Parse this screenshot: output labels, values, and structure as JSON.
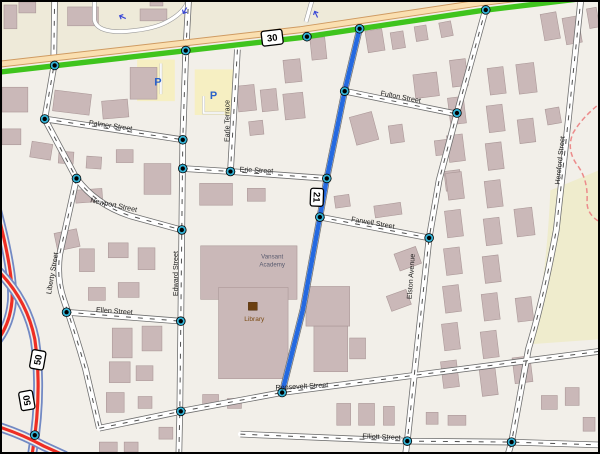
{
  "map": {
    "colors": {
      "background": "#f2efe9",
      "north_zone": "#eeead9",
      "east_zone": "#efeccd",
      "building": "#cab8b8",
      "route30_green": "#3fc41d",
      "route30_road": "#fadfb0",
      "highlight_route_blue": "#2469e0",
      "motorway_red": "#ee2e24",
      "motorway_blue": "#7289c4",
      "node_ring": "#34b3d6",
      "parking_fill": "#f6efc2",
      "parking_letter": "#2a62c9",
      "footpath_red": "#ec8b8b"
    },
    "shields": [
      {
        "label": "30",
        "x": 272,
        "y": 36,
        "rot": -7,
        "w": 21,
        "h": 15
      },
      {
        "label": "21",
        "x": 317,
        "y": 197,
        "rot": 92,
        "w": 18,
        "h": 13
      },
      {
        "label": "50",
        "x": 36,
        "y": 361,
        "rot": -80,
        "w": 19,
        "h": 14
      },
      {
        "label": "50",
        "x": 25,
        "y": 402,
        "rot": -100,
        "w": 19,
        "h": 14
      }
    ],
    "street_labels": [
      {
        "label": "Palmer Street",
        "x": 109,
        "y": 127,
        "rot": 8
      },
      {
        "label": "Erie Street",
        "x": 256,
        "y": 172,
        "rot": 3
      },
      {
        "label": "Earle Terrace",
        "x": 229,
        "y": 120,
        "rot": -90
      },
      {
        "label": "Fulton Street",
        "x": 401,
        "y": 98,
        "rot": 11
      },
      {
        "label": "Newport Street",
        "x": 112,
        "y": 207,
        "rot": 12
      },
      {
        "label": "Edward Street",
        "x": 177,
        "y": 274,
        "rot": -90
      },
      {
        "label": "Farwell Street",
        "x": 373,
        "y": 225,
        "rot": 10
      },
      {
        "label": "Elston Avenue",
        "x": 414,
        "y": 277,
        "rot": -86
      },
      {
        "label": "Hereford Street",
        "x": 564,
        "y": 160,
        "rot": -84
      },
      {
        "label": "Liberty Street",
        "x": 53,
        "y": 274,
        "rot": -80
      },
      {
        "label": "Ellen Street",
        "x": 113,
        "y": 314,
        "rot": 4
      },
      {
        "label": "Roosevelt Street",
        "x": 302,
        "y": 390,
        "rot": -3
      },
      {
        "label": "Elliott Street",
        "x": 382,
        "y": 441,
        "rot": 2
      }
    ],
    "poi_labels": [
      {
        "label": "Vansant",
        "x": 272,
        "y": 259,
        "cls": "academy"
      },
      {
        "label": "Academy",
        "x": 272,
        "y": 267,
        "cls": "academy"
      },
      {
        "label": "Library",
        "x": 254,
        "y": 322,
        "cls": "library"
      },
      {
        "label": "P",
        "x": 157,
        "y": 84,
        "cls": "parking"
      },
      {
        "label": "P",
        "x": 213,
        "y": 98,
        "cls": "parking"
      }
    ],
    "nodes": [
      [
        53,
        64
      ],
      [
        185,
        49
      ],
      [
        307,
        35
      ],
      [
        360,
        27
      ],
      [
        487,
        8
      ],
      [
        345,
        90
      ],
      [
        327,
        178
      ],
      [
        320,
        217
      ],
      [
        282,
        394
      ],
      [
        43,
        118
      ],
      [
        182,
        139
      ],
      [
        75,
        178
      ],
      [
        182,
        168
      ],
      [
        230,
        171
      ],
      [
        181,
        230
      ],
      [
        65,
        313
      ],
      [
        180,
        322
      ],
      [
        458,
        112
      ],
      [
        430,
        238
      ],
      [
        180,
        413
      ],
      [
        408,
        443
      ],
      [
        513,
        444
      ],
      [
        33,
        437
      ]
    ],
    "arrows": [
      [
        121,
        15,
        205
      ],
      [
        184,
        9,
        120
      ],
      [
        316,
        12,
        245
      ]
    ],
    "buildings": [
      [
        2,
        3,
        13,
        24,
        0
      ],
      [
        17,
        0,
        17,
        11,
        0
      ],
      [
        66,
        5,
        31,
        19,
        0
      ],
      [
        139,
        7,
        27,
        12,
        0
      ],
      [
        149,
        0,
        13,
        4,
        0
      ],
      [
        0,
        86,
        26,
        25,
        0
      ],
      [
        52,
        91,
        37,
        21,
        7
      ],
      [
        101,
        99,
        26,
        18,
        -5
      ],
      [
        129,
        66,
        27,
        32,
        0
      ],
      [
        0,
        128,
        19,
        16,
        0
      ],
      [
        29,
        142,
        21,
        16,
        9
      ],
      [
        57,
        151,
        15,
        12,
        4
      ],
      [
        85,
        156,
        15,
        12,
        4
      ],
      [
        115,
        149,
        17,
        13,
        0
      ],
      [
        143,
        163,
        27,
        31,
        0
      ],
      [
        54,
        231,
        23,
        18,
        -12
      ],
      [
        78,
        249,
        15,
        23,
        0
      ],
      [
        107,
        243,
        20,
        15,
        0
      ],
      [
        137,
        248,
        17,
        22,
        0
      ],
      [
        87,
        288,
        17,
        13,
        0
      ],
      [
        117,
        283,
        21,
        15,
        0
      ],
      [
        74,
        189,
        27,
        13,
        -4
      ],
      [
        111,
        329,
        20,
        30,
        0
      ],
      [
        141,
        327,
        20,
        25,
        0
      ],
      [
        108,
        363,
        21,
        21,
        0
      ],
      [
        135,
        367,
        17,
        15,
        0
      ],
      [
        105,
        394,
        18,
        20,
        0
      ],
      [
        137,
        398,
        14,
        12,
        0
      ],
      [
        98,
        444,
        18,
        10,
        0
      ],
      [
        123,
        444,
        14,
        10,
        0
      ],
      [
        158,
        429,
        14,
        12,
        0
      ],
      [
        202,
        396,
        16,
        12,
        0
      ],
      [
        227,
        400,
        14,
        10,
        0
      ],
      [
        337,
        405,
        14,
        22,
        0
      ],
      [
        359,
        405,
        16,
        22,
        0
      ],
      [
        384,
        408,
        11,
        19,
        0
      ],
      [
        427,
        414,
        12,
        12,
        0
      ],
      [
        449,
        417,
        18,
        10,
        0
      ],
      [
        200,
        246,
        97,
        54,
        0
      ],
      [
        218,
        288,
        70,
        92,
        0
      ],
      [
        237,
        84,
        18,
        26,
        -6
      ],
      [
        261,
        88,
        16,
        22,
        -6
      ],
      [
        284,
        92,
        20,
        26,
        -6
      ],
      [
        249,
        120,
        14,
        14,
        -6
      ],
      [
        284,
        58,
        17,
        23,
        -6
      ],
      [
        311,
        36,
        15,
        22,
        -6
      ],
      [
        199,
        183,
        33,
        22,
        0
      ],
      [
        247,
        188,
        18,
        13,
        0
      ],
      [
        367,
        28,
        17,
        22,
        -9
      ],
      [
        392,
        30,
        13,
        17,
        -9
      ],
      [
        416,
        24,
        12,
        15,
        -9
      ],
      [
        441,
        20,
        12,
        15,
        -11
      ],
      [
        415,
        72,
        24,
        24,
        -7
      ],
      [
        353,
        113,
        23,
        29,
        -15
      ],
      [
        390,
        124,
        14,
        18,
        -8
      ],
      [
        436,
        139,
        18,
        15,
        -7
      ],
      [
        446,
        170,
        16,
        20,
        -7
      ],
      [
        375,
        204,
        27,
        12,
        -8
      ],
      [
        335,
        195,
        15,
        12,
        -8
      ],
      [
        306,
        287,
        44,
        40,
        0
      ],
      [
        314,
        327,
        34,
        46,
        0
      ],
      [
        350,
        339,
        16,
        21,
        0
      ],
      [
        397,
        250,
        23,
        18,
        -20
      ],
      [
        389,
        293,
        21,
        16,
        -20
      ],
      [
        452,
        58,
        16,
        27,
        -7
      ],
      [
        450,
        96,
        16,
        27,
        -7
      ],
      [
        449,
        134,
        16,
        27,
        -7
      ],
      [
        448,
        172,
        16,
        27,
        -7
      ],
      [
        447,
        210,
        16,
        27,
        -7
      ],
      [
        446,
        248,
        16,
        27,
        -7
      ],
      [
        445,
        286,
        16,
        27,
        -7
      ],
      [
        444,
        324,
        16,
        27,
        -7
      ],
      [
        443,
        362,
        16,
        27,
        -7
      ],
      [
        490,
        66,
        16,
        27,
        -7
      ],
      [
        489,
        104,
        16,
        27,
        -7
      ],
      [
        488,
        142,
        16,
        27,
        -7
      ],
      [
        487,
        180,
        16,
        27,
        -7
      ],
      [
        486,
        218,
        16,
        27,
        -7
      ],
      [
        485,
        256,
        16,
        27,
        -7
      ],
      [
        484,
        294,
        16,
        27,
        -7
      ],
      [
        483,
        332,
        16,
        27,
        -7
      ],
      [
        482,
        370,
        16,
        27,
        -7
      ],
      [
        519,
        62,
        18,
        30,
        -7
      ],
      [
        520,
        118,
        16,
        24,
        -7
      ],
      [
        517,
        208,
        18,
        28,
        -7
      ],
      [
        518,
        298,
        16,
        24,
        -7
      ],
      [
        515,
        358,
        18,
        26,
        -7
      ],
      [
        544,
        11,
        16,
        27,
        -10
      ],
      [
        566,
        15,
        16,
        27,
        -10
      ],
      [
        548,
        107,
        14,
        16,
        -10
      ],
      [
        590,
        6,
        10,
        20,
        -10
      ],
      [
        543,
        397,
        16,
        14,
        0
      ],
      [
        567,
        389,
        14,
        18,
        0
      ],
      [
        585,
        419,
        12,
        14,
        0
      ]
    ]
  }
}
